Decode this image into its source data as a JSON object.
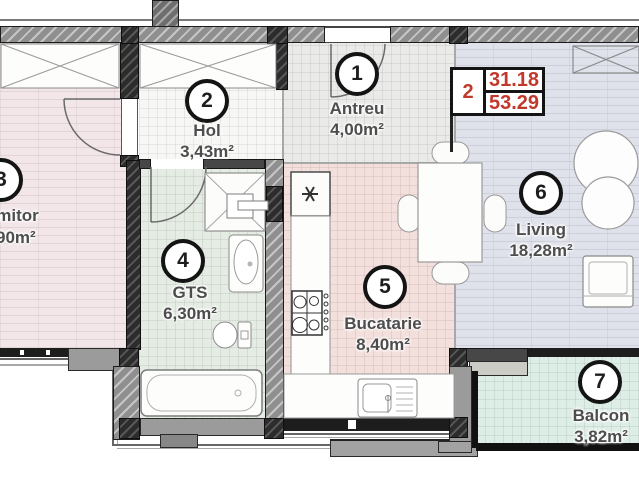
{
  "info_box": {
    "unit_number": "2",
    "value_top": "31.18",
    "value_bottom": "53.29"
  },
  "rooms": [
    {
      "number": "1",
      "name": "Antreu",
      "area": "4,00m²"
    },
    {
      "number": "2",
      "name": "Hol",
      "area": "3,43m²"
    },
    {
      "number": "3",
      "name": "Dormitor",
      "area": "90m²"
    },
    {
      "number": "4",
      "name": "GTS",
      "area": "6,30m²"
    },
    {
      "number": "5",
      "name": "Bucatarie",
      "area": "8,40m²"
    },
    {
      "number": "6",
      "name": "Living",
      "area": "18,28m²"
    },
    {
      "number": "7",
      "name": "Balcon",
      "area": "3,82m²"
    }
  ],
  "colors": {
    "accent_red": "#c0392b",
    "label_text": "#4d4d4d",
    "wall_gray": "#9b9b9b",
    "floor_bedroom": "#f3e6e8",
    "floor_living": "#dfe2eb",
    "floor_kitchen": "#f3dfdc",
    "floor_bath": "#e4ece3",
    "floor_balcony": "#ddeee6"
  }
}
